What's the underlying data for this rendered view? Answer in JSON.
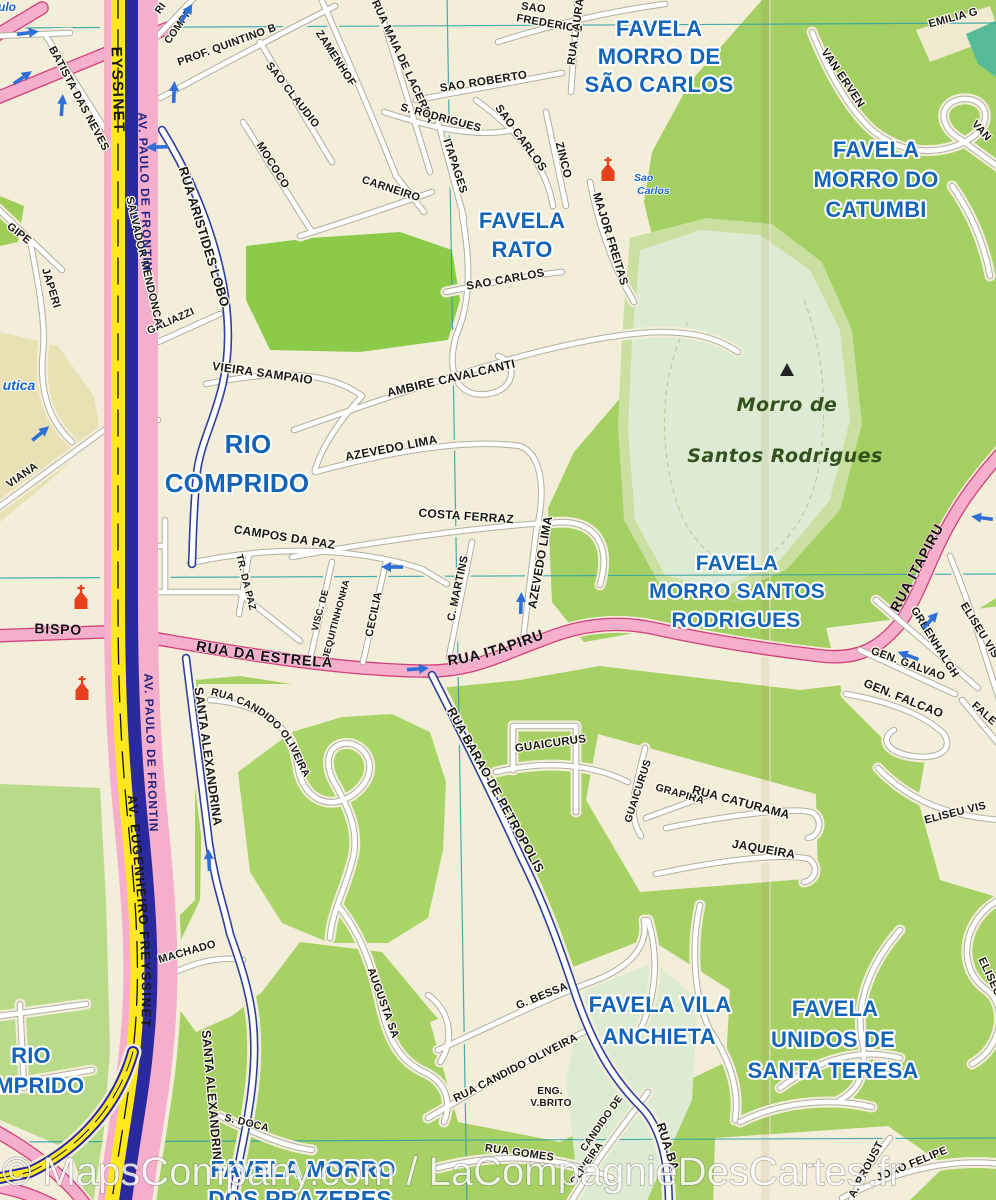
{
  "watermark": "© MapsCompany.com / LaCompagnieDesCartes.fr",
  "colors": {
    "favela_blue": "#1464b8",
    "road_pink": "#f5aecb",
    "highway_yellow": "#ffe81f",
    "green": "#a7d065",
    "mint": "#dcebd2",
    "grid_teal": "#2aa0a4",
    "arrow_blue": "#2e6fd8",
    "church_red": "#e8401c"
  },
  "favela_labels": [
    [
      "FAVELA",
      659,
      36,
      22
    ],
    [
      "MORRO DE",
      659,
      64,
      22
    ],
    [
      "SÃO CARLOS",
      659,
      92,
      22
    ],
    [
      "FAVELA",
      522,
      228,
      22
    ],
    [
      "RATO",
      522,
      257,
      22
    ],
    [
      "FAVELA",
      876,
      157,
      22
    ],
    [
      "MORRO DO",
      876,
      187,
      22
    ],
    [
      "CATUMBI",
      876,
      217,
      22
    ],
    [
      "RIO",
      248,
      453,
      26
    ],
    [
      "COMPRIDO",
      237,
      492,
      26
    ],
    [
      "FAVELA",
      737,
      570,
      21
    ],
    [
      "MORRO SANTOS",
      737,
      598,
      21
    ],
    [
      "RODRIGUES",
      736,
      627,
      21
    ],
    [
      "FAVELA VILA",
      660,
      1012,
      22
    ],
    [
      "ANCHIETA",
      659,
      1044,
      22
    ],
    [
      "FAVELA",
      835,
      1016,
      22
    ],
    [
      "UNIDOS DE",
      833,
      1047,
      22
    ],
    [
      "SANTA TERESA",
      833,
      1078,
      22
    ],
    [
      "FAVELA MORRO",
      303,
      1177,
      23
    ],
    [
      "DOS PRAZERES",
      300,
      1207,
      23
    ],
    [
      "RIO",
      31,
      1063,
      22
    ],
    [
      "COMPRIDO",
      23,
      1093,
      22
    ]
  ],
  "street_labels": [
    [
      "PROF. QUINTINO B",
      228,
      48,
      -20
    ],
    [
      "BATISTA DAS NEVES",
      76,
      100,
      62
    ],
    [
      "SAO CLAUDIO",
      290,
      97,
      52
    ],
    [
      "MOCOCO",
      270,
      167,
      58
    ],
    [
      "ZAMENHOF",
      333,
      60,
      57
    ],
    [
      "CARNEIRO",
      390,
      192,
      18
    ],
    [
      "RUA MAIA DE LACERDA",
      400,
      63,
      65
    ],
    [
      "S. RODRIGUES",
      440,
      121,
      15
    ],
    [
      "ITAPAGES",
      452,
      167,
      72
    ],
    [
      "SAO ROBERTO",
      484,
      85,
      -9,
      11.5
    ],
    [
      "SAO",
      533,
      11,
      8
    ],
    [
      "FREDERICO",
      549,
      27,
      10
    ],
    [
      "RUA LAURA",
      579,
      32,
      -82
    ],
    [
      "SAO CARLOS",
      518,
      140,
      54,
      11.5
    ],
    [
      "ZINCO",
      560,
      161,
      76,
      11.5
    ],
    [
      "MAJOR FREITAS",
      607,
      240,
      73,
      11.5
    ],
    [
      "SAO CARLOS",
      506,
      283,
      -10,
      11.5
    ],
    [
      "VAN ERVEN",
      840,
      80,
      56,
      11.5
    ],
    [
      "EMILIA G",
      954,
      21,
      -15
    ],
    [
      "VAN",
      979,
      133,
      48
    ],
    [
      "RI",
      163,
      10,
      -55,
      10.5
    ],
    [
      "COMPR",
      181,
      28,
      -55,
      10.5
    ],
    [
      "GALIAZZI",
      172,
      324,
      -24,
      10.5
    ],
    [
      "RUA ARISTIDES LOBO",
      200,
      238,
      73,
      13
    ],
    [
      "SALVADOR MENDONCA",
      141,
      262,
      77
    ],
    [
      "JAPERI",
      48,
      289,
      73
    ],
    [
      "GIPE",
      17,
      236,
      38
    ],
    [
      "VIANA",
      24,
      478,
      -35
    ],
    [
      "VIEIRA SAMPAIO",
      262,
      377,
      8,
      12
    ],
    [
      "AMBIRE CAVALCANTI",
      452,
      382,
      -13,
      12
    ],
    [
      "AZEVEDO LIMA",
      392,
      452,
      -11,
      12
    ],
    [
      "COSTA FERRAZ",
      466,
      520,
      4,
      12
    ],
    [
      "CAMPOS DA PAZ",
      284,
      541,
      9,
      12
    ],
    [
      "TR. DA PAZ",
      243,
      583,
      76,
      10
    ],
    [
      "VISC. DE",
      323,
      611,
      -75,
      9.5
    ],
    [
      "JEQUITINHONHA",
      339,
      620,
      -75,
      9.5
    ],
    [
      "CECILIA",
      377,
      615,
      -78
    ],
    [
      "C. MARTINS",
      461,
      589,
      -78
    ],
    [
      "AZEVEDO LIMA",
      544,
      563,
      -80,
      12
    ],
    [
      "GREENHALGH",
      932,
      644,
      58
    ],
    [
      "ELISEU VIS",
      977,
      632,
      58
    ],
    [
      "GEN. GALVAO",
      907,
      667,
      20
    ],
    [
      "GEN. FALCAO",
      902,
      702,
      22,
      12
    ],
    [
      "FALE",
      982,
      716,
      42
    ],
    [
      "ELISEU VIS",
      956,
      816,
      -14
    ],
    [
      "ELISEU",
      987,
      978,
      65
    ],
    [
      "GUAICURUS",
      551,
      747,
      -8,
      11.5
    ],
    [
      "GUAICURUS",
      641,
      792,
      -72,
      10.5
    ],
    [
      "GRAPIRA",
      679,
      797,
      16,
      10.5
    ],
    [
      "RUA CATURAMA",
      740,
      806,
      15,
      12
    ],
    [
      "JAQUEIRA",
      763,
      853,
      10,
      12
    ],
    [
      "RUA BARAO DE PETROPOLIS",
      492,
      792,
      61,
      12.5
    ],
    [
      "MACHADO",
      188,
      955,
      -16
    ],
    [
      "AUGUSTA SA",
      380,
      1004,
      70
    ],
    [
      "SANTA ALEXANDRINA",
      204,
      757,
      82,
      12.5
    ],
    [
      "SANTA ALEXANDRINA",
      208,
      1100,
      85,
      12.5
    ],
    [
      "S. DOCA",
      246,
      1126,
      14,
      10.5
    ],
    [
      "G. BESSA",
      543,
      999,
      -22
    ],
    [
      "RUA CANDIDO OLIVEIRA",
      517,
      1071,
      -27
    ],
    [
      "ENG.",
      550,
      1094,
      0,
      10
    ],
    [
      "V.BRITO",
      551,
      1106,
      0,
      10
    ],
    [
      "RUA GOMES",
      519,
      1156,
      8
    ],
    [
      "CANDIDO DE",
      604,
      1125,
      -55,
      10
    ],
    [
      "OLIVEIRA",
      589,
      1165,
      -55,
      10
    ],
    [
      "RUA BA",
      664,
      1148,
      72,
      12.5
    ],
    [
      "A. PROUST",
      869,
      1171,
      -62
    ],
    [
      "JOAO FELIPE",
      913,
      1167,
      -22
    ]
  ],
  "road_labels": [
    [
      "BISPO",
      58,
      634,
      2,
      14
    ],
    [
      "RUA ITAPIRU",
      921,
      570,
      -62,
      14
    ]
  ],
  "path_labels": [
    {
      "t": "RUA DA ESTRELA",
      "path": "lp-estrela",
      "size": 14.5,
      "offset": "6%",
      "cls": "lbl-road"
    },
    {
      "t": "RUA ITAPIRU",
      "path": "lp-itapiru",
      "size": 14.5,
      "offset": "4%",
      "cls": "lbl-road"
    },
    {
      "t": "RUA CANDIDO OLIVEIRA",
      "path": "lp-cand",
      "size": 10.5,
      "offset": "2%",
      "cls": "lbl"
    },
    {
      "t": "AV. EUGENHEIRO FREYSSINET",
      "path": "lp-frey",
      "size": 13,
      "offset": "2%",
      "cls": "lbl-hwy-dark"
    }
  ],
  "hwy_labels": [
    [
      "EYSSINET",
      113,
      90,
      88,
      15,
      "dark"
    ],
    [
      "AV. PAULO DE FRONTIN",
      141,
      192,
      88,
      12,
      "navy"
    ],
    [
      "AV. PAULO DE FRONTIN",
      147,
      753,
      88,
      12,
      "navy"
    ]
  ],
  "italic_labels": [
    [
      "ulo",
      7,
      11,
      12
    ],
    [
      "utica",
      19,
      390,
      14
    ]
  ],
  "poi": {
    "peak": [
      787,
      371
    ],
    "peak_label": [
      "Morro de",
      "Santos Rodrigues"
    ],
    "peak_label_pos": [
      [
        787,
        411
      ],
      [
        785,
        462
      ]
    ],
    "church_label": [
      "Sao",
      "Carlos"
    ],
    "church_label_pos": [
      [
        634,
        181
      ],
      [
        637,
        194
      ]
    ],
    "churches": [
      [
        608,
        173
      ],
      [
        81,
        601
      ],
      [
        82,
        692
      ]
    ]
  },
  "arrows": [
    [
      27,
      33,
      -8
    ],
    [
      186,
      14,
      -58
    ],
    [
      22,
      78,
      -35
    ],
    [
      62,
      106,
      -86
    ],
    [
      174,
      93,
      -88
    ],
    [
      158,
      147,
      178
    ],
    [
      40,
      434,
      -40
    ],
    [
      393,
      567,
      180
    ],
    [
      521,
      604,
      -88
    ],
    [
      417,
      669,
      -4
    ],
    [
      209,
      861,
      -93
    ],
    [
      983,
      518,
      188
    ],
    [
      930,
      621,
      -48
    ],
    [
      909,
      656,
      200
    ]
  ]
}
